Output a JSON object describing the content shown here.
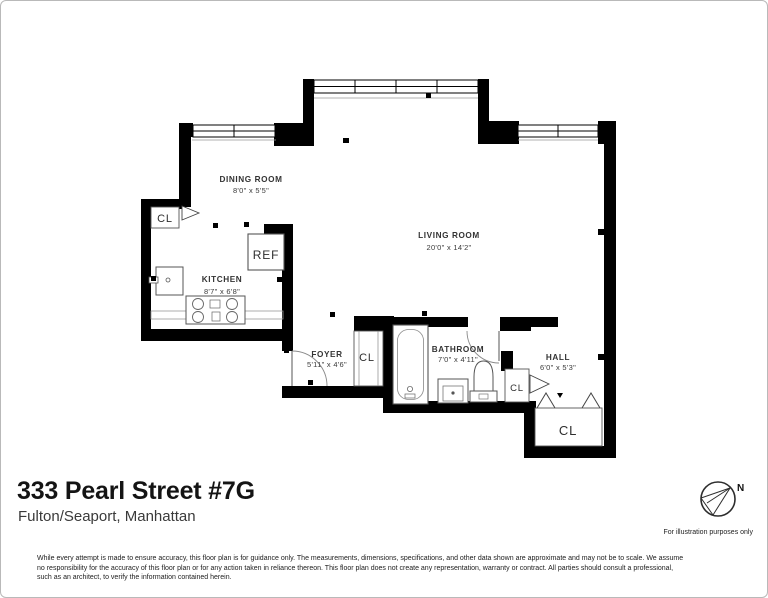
{
  "header": {
    "title": "333 Pearl Street #7G",
    "subtitle": "Fulton/Seaport, Manhattan"
  },
  "rooms": {
    "dining": {
      "name": "DINING ROOM",
      "dims": "8'0\" x 5'5\""
    },
    "living": {
      "name": "LIVING ROOM",
      "dims": "20'0\" x 14'2\""
    },
    "kitchen": {
      "name": "KITCHEN",
      "dims": "8'7\" x 6'8\""
    },
    "foyer": {
      "name": "FOYER",
      "dims": "5'11\" x 4'6\""
    },
    "bathroom": {
      "name": "BATHROOM",
      "dims": "7'0\" x 4'11\""
    },
    "hall": {
      "name": "HALL",
      "dims": "6'0\" x 5'3\""
    }
  },
  "labels": {
    "closet": "CL",
    "refrigerator": "REF"
  },
  "compass": {
    "north": "N",
    "note": "For illustration purposes only"
  },
  "disclaimer": {
    "line1": "While every attempt is made to ensure accuracy, this floor plan is for guidance only. The measurements, dimensions, specifications, and other data shown are approximate and may not be to scale.  We assume",
    "line2": "no responsibility for the accuracy of this floor plan or for any action taken in reliance thereon. This floor plan does not create any representation, warranty or contract. All parties should consult a professional,",
    "line3": "such as an architect, to verify the information contained herein."
  },
  "colors": {
    "wall": "#000000",
    "fixture_line": "#555555",
    "text": "#2e2e2e"
  }
}
